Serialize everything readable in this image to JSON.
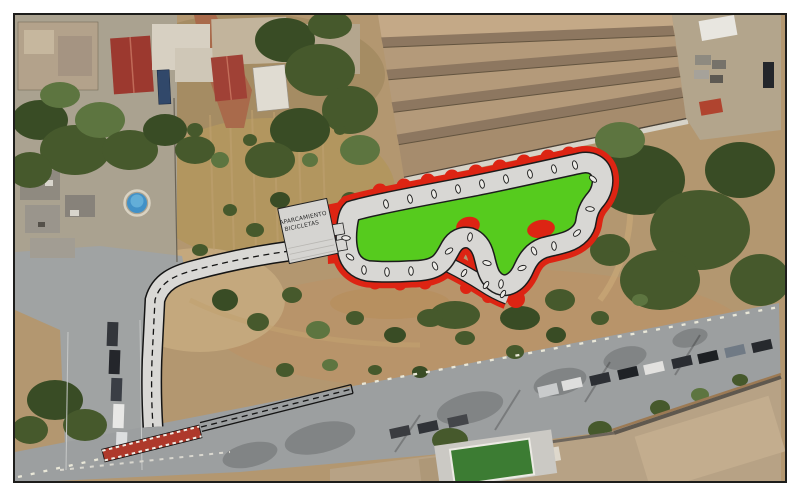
{
  "parking": {
    "label_line1": "APARCAMIENTO",
    "label_line2": "BICICLETAS"
  },
  "colors": {
    "frame_border": "#1d1d1b",
    "page_bg": "#ffffff",
    "berm_red": "#dd2413",
    "infield_green": "#56cb1e",
    "track_surface": "#d8d7d4",
    "track_outline": "#1c1c1c",
    "parking_fill": "#d5d4d1",
    "strip_red": "#ae392b"
  }
}
